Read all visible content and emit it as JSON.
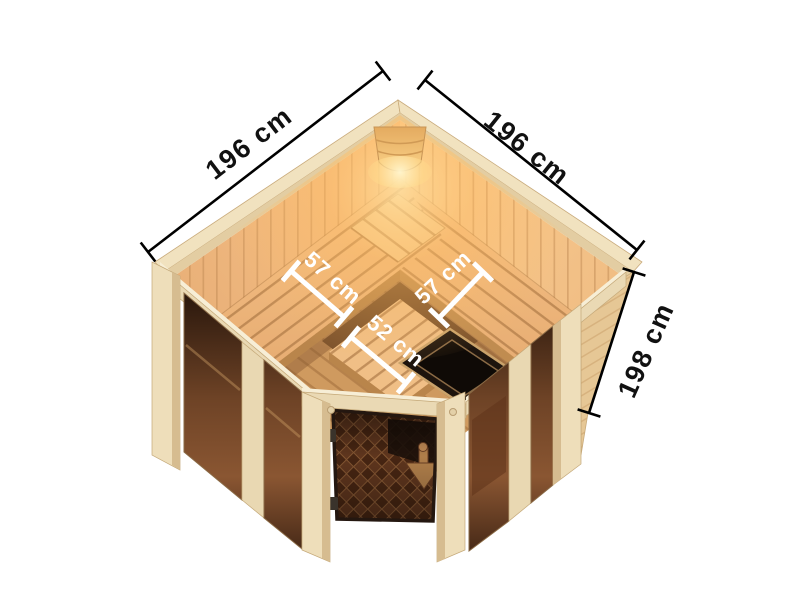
{
  "dims": {
    "left_wall": "196 cm",
    "right_wall": "196 cm",
    "height": "198 cm",
    "bench_left": "57 cm",
    "bench_right": "57 cm",
    "bench_front": "52 cm"
  },
  "colors": {
    "background": "#ffffff",
    "dimension_line": "#000000",
    "dimension_text": "#111111",
    "interior_dim_text": "#ffffff",
    "wood_frame": "#eedeba",
    "wood_beam": "#ead9b4",
    "beam_highlight": "#f7eed6",
    "roof_edge": "#f1e2bf",
    "wood_wall_warm": "#f3bd83",
    "wood_bench": "#eeb87c",
    "slat_gap": "#a3703d",
    "fascia": "#b9854b",
    "glass_bronze": "#6e4326",
    "heater_dark": "#1d140d",
    "hinge": "#3a332b",
    "lamp_glow": "#ffd98f",
    "exterior_plank": "#e6c795"
  }
}
